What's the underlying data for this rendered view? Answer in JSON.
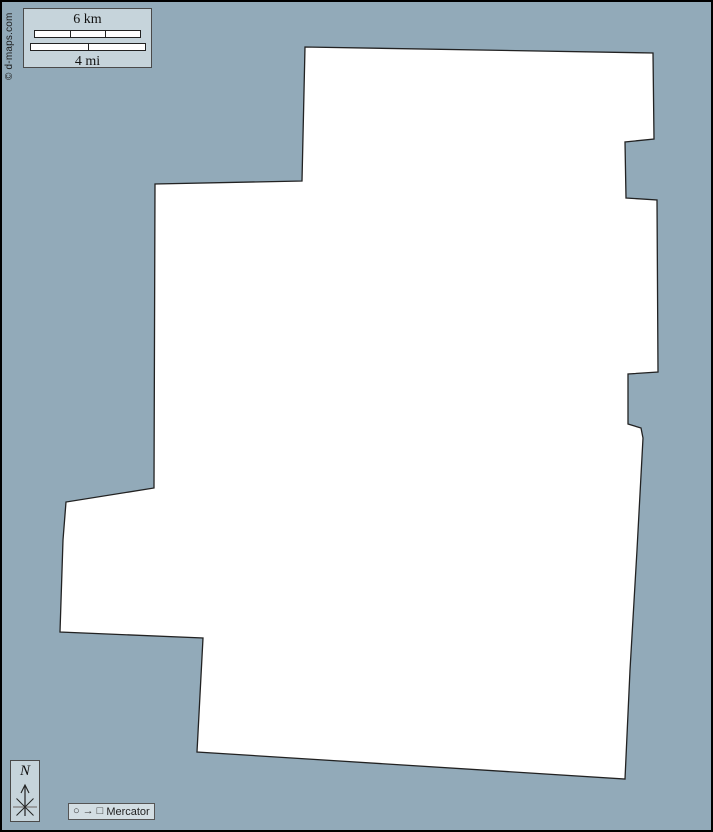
{
  "page": {
    "background_color": "#92aab9",
    "frame_border_color": "#000000"
  },
  "copyright": {
    "text": "© d-maps.com"
  },
  "scale_box": {
    "km_label": "6 km",
    "mi_label": "4 mi"
  },
  "compass": {
    "north_label": "N"
  },
  "projection": {
    "circle_icon": "○",
    "arrow_icon": "→",
    "square_icon": "□",
    "label": "Mercator"
  },
  "map": {
    "fill_color": "#ffffff",
    "stroke_color": "#222222",
    "outline_points": "305,47 653,53 654,139 625,142 626,198 657,200 658,372 628,374 628,424 641,428 643,438 637,550 630,670 625,779 197,752 203,638 60,632 63,540 66,502 154,488 155,184 302,181"
  }
}
